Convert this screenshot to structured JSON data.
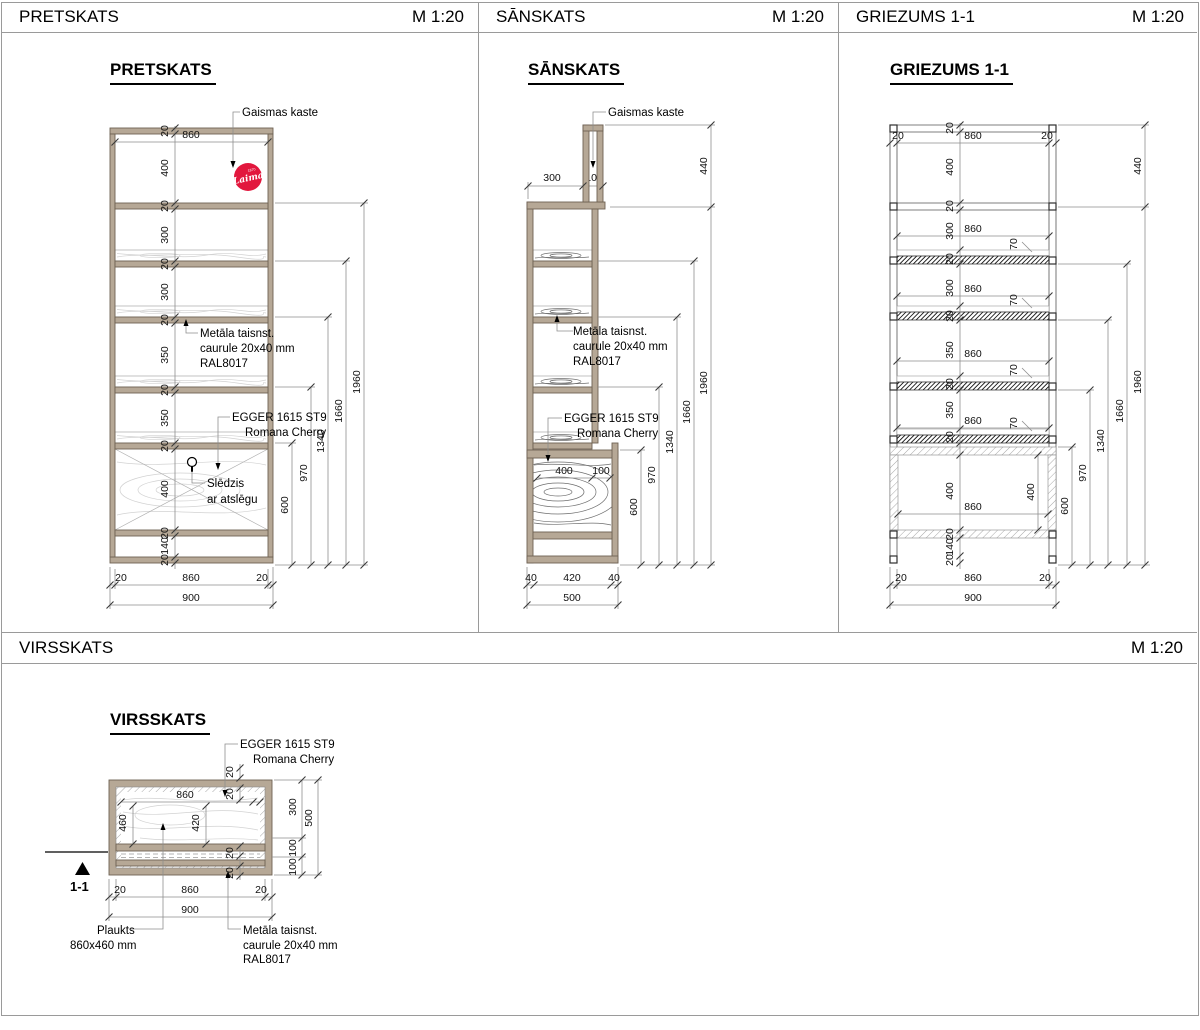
{
  "sheet": {
    "panels_row1": [
      {
        "title": "PRETSKATS",
        "scale": "M 1:20"
      },
      {
        "title": "SĀNSKATS",
        "scale": "M 1:20"
      },
      {
        "title": "GRIEZUMS 1-1",
        "scale": "M 1:20"
      }
    ],
    "panel_row2": {
      "title": "VIRSSKATS",
      "scale": "M 1:20"
    }
  },
  "view_titles": {
    "pretskats": "PRETSKATS",
    "sanskats": "SĀNSKATS",
    "griezums": "GRIEZUMS 1-1",
    "virsskats": "VIRSSKATS"
  },
  "annotations": {
    "gaismas_kaste": "Gaismas kaste",
    "metala_l1": "Metāla taisnst.",
    "metala_l2": "caurule 20x40 mm",
    "metala_l3": "RAL8017",
    "egger_l1": "EGGER 1615 ST9",
    "egger_l2": "Romana Cherry",
    "sledzis_l1": "Slēdzis",
    "sledzis_l2": "ar atslēgu",
    "plaukts_l1": "Plaukts",
    "plaukts_l2": "860x460 mm",
    "section_label": "1-1"
  },
  "logo": {
    "brand": "Laima",
    "year": "1870",
    "color": "#e2173d"
  },
  "dims": {
    "pretskats": {
      "top_width": "860",
      "chain": [
        "20",
        "400",
        "20",
        "300",
        "20",
        "300",
        "20",
        "350",
        "20",
        "350",
        "20",
        "400",
        "20",
        "140",
        "20"
      ],
      "cumulative": [
        "600",
        "970",
        "1340",
        "1660",
        "1960"
      ],
      "bottom": [
        "20",
        "860",
        "20"
      ],
      "total_width": "900"
    },
    "sanskats": {
      "top_depth": "300",
      "box_depth": "100",
      "box_height": "440",
      "cumulative": [
        "600",
        "970",
        "1340",
        "1660",
        "1960"
      ],
      "inner": [
        "400",
        "100"
      ],
      "bottom": [
        "40",
        "420",
        "40"
      ],
      "total_depth": "500"
    },
    "griezums": {
      "top": [
        "20",
        "860",
        "20"
      ],
      "chain": [
        "20",
        "400",
        "20",
        "300",
        "20",
        "300",
        "20",
        "350",
        "20",
        "350",
        "20",
        "400",
        "20",
        "140",
        "20"
      ],
      "section_widths": [
        "860",
        "860",
        "860",
        "860",
        "860"
      ],
      "shelf_thickness": [
        "70",
        "70",
        "70",
        "70"
      ],
      "box_height": "440",
      "cumulative": [
        "600",
        "970",
        "1340",
        "1660",
        "1960"
      ],
      "inner_depth": "400",
      "bottom": [
        "20",
        "860",
        "20"
      ],
      "total_width": "900"
    },
    "virsskats": {
      "frame_20s": [
        "20",
        "20",
        "20",
        "20"
      ],
      "board_width": "860",
      "board_depth": "460",
      "inner_width": "420",
      "right": [
        "300",
        "100",
        "100"
      ],
      "total_depth": "500",
      "bottom": [
        "20",
        "860",
        "20"
      ],
      "total_width": "900"
    }
  }
}
